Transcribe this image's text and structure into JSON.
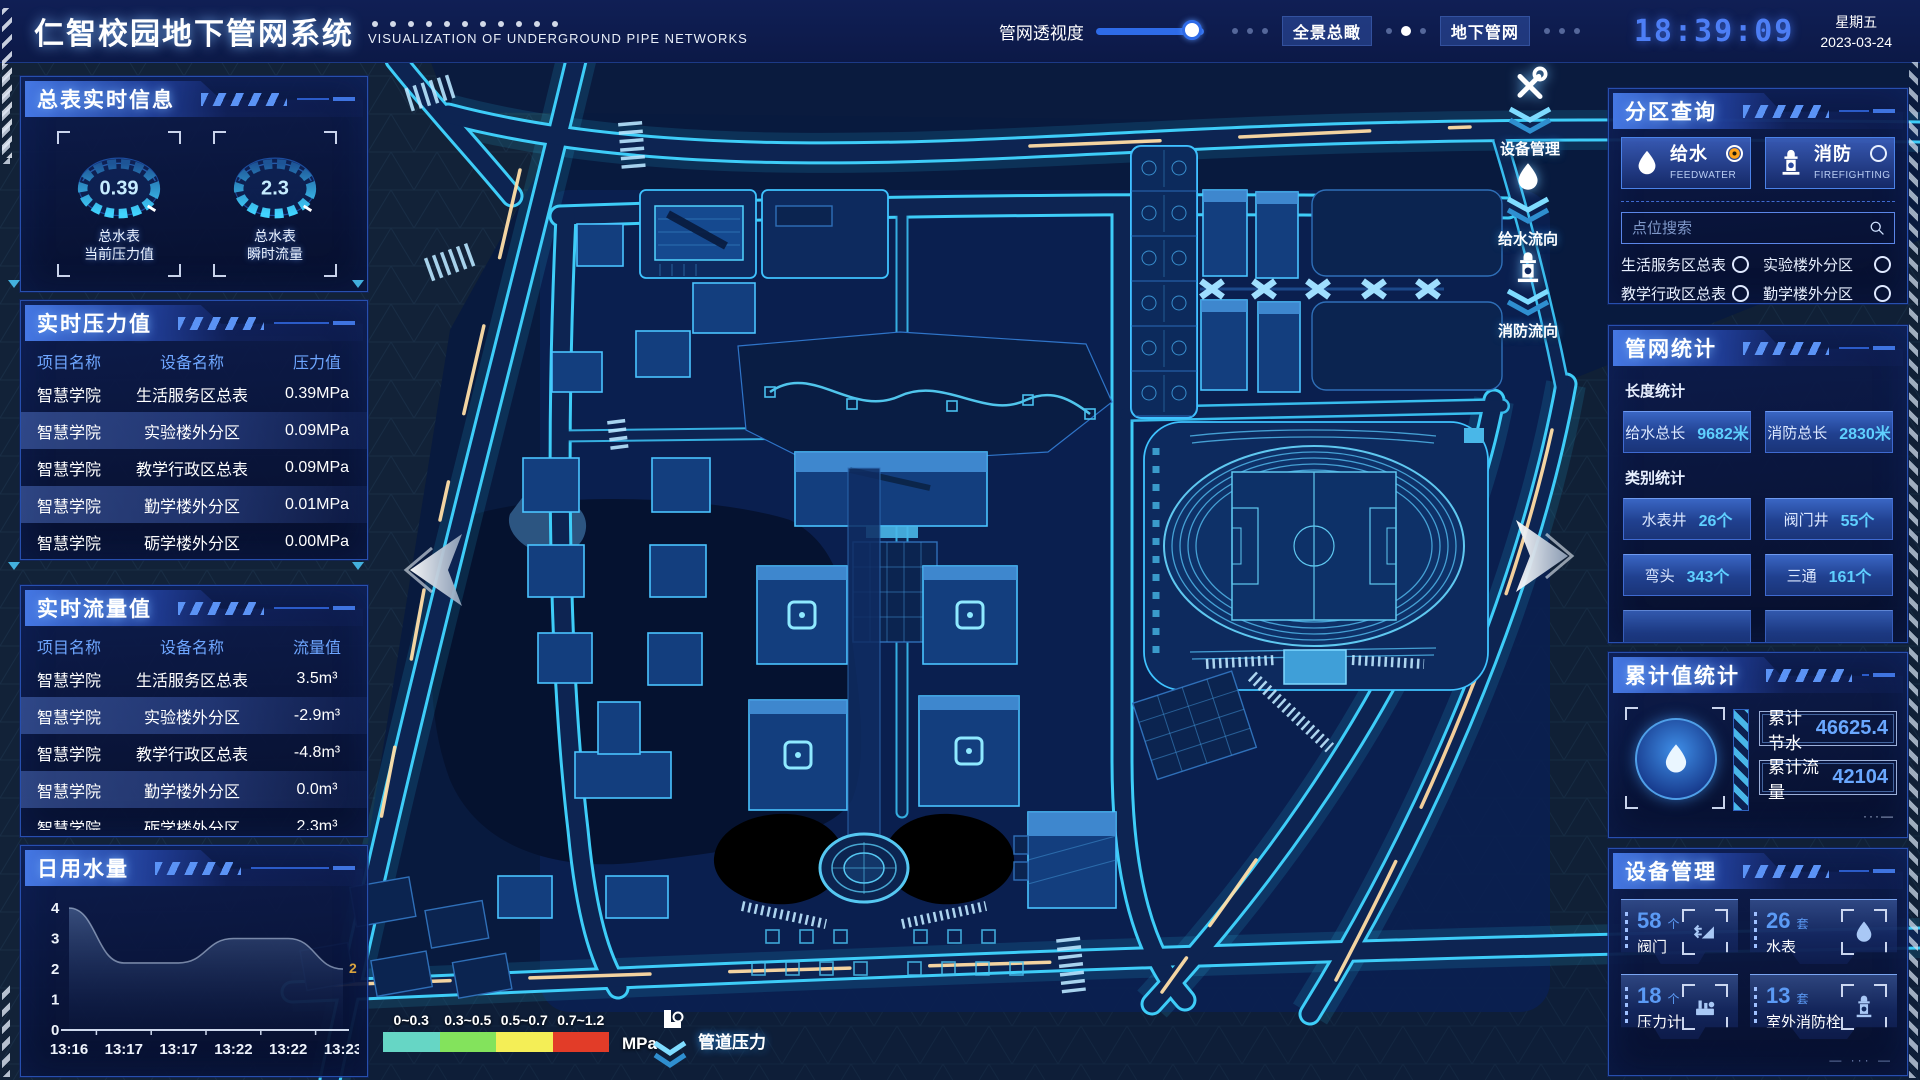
{
  "header": {
    "title": "仁智校园地下管网系统",
    "subtitle": "VISUALIZATION OF UNDERGROUND PIPE NETWORKS",
    "slider_label": "管网透视度",
    "view_buttons": [
      {
        "label": "全景总瞰"
      },
      {
        "label": "地下管网"
      }
    ],
    "clock": {
      "time": "18:39:09",
      "weekday": "星期五",
      "date": "2023-03-24"
    }
  },
  "left": {
    "meter_panel": {
      "title": "总表实时信息",
      "gauges": [
        {
          "value": "0.39",
          "name": "总水表",
          "metric": "当前压力值"
        },
        {
          "value": "2.3",
          "name": "总水表",
          "metric": "瞬时流量"
        }
      ]
    },
    "pressure_panel": {
      "title": "实时压力值",
      "headers": [
        "项目名称",
        "设备名称",
        "压力值"
      ],
      "rows": [
        [
          "智慧学院",
          "生活服务区总表",
          "0.39MPa"
        ],
        [
          "智慧学院",
          "实验楼外分区",
          "0.09MPa"
        ],
        [
          "智慧学院",
          "教学行政区总表",
          "0.09MPa"
        ],
        [
          "智慧学院",
          "勤学楼外分区",
          "0.01MPa"
        ],
        [
          "智慧学院",
          "砺学楼外分区",
          "0.00MPa"
        ]
      ]
    },
    "flow_panel": {
      "title": "实时流量值",
      "headers": [
        "项目名称",
        "设备名称",
        "流量值"
      ],
      "rows": [
        [
          "智慧学院",
          "生活服务区总表",
          "3.5m³"
        ],
        [
          "智慧学院",
          "实验楼外分区",
          "-2.9m³"
        ],
        [
          "智慧学院",
          "教学行政区总表",
          "-4.8m³"
        ],
        [
          "智慧学院",
          "勤学楼外分区",
          "0.0m³"
        ],
        [
          "智慧学院",
          "砺学楼外分区",
          "2.3m³"
        ]
      ]
    },
    "daily_panel": {
      "title": "日用水量"
    }
  },
  "chart_data": {
    "type": "area",
    "title": "日用水量",
    "x": [
      "13:16",
      "13:17",
      "13:17",
      "13:22",
      "13:22",
      "13:23"
    ],
    "values": [
      4,
      2.2,
      2.2,
      3,
      3,
      2
    ],
    "ylim": [
      0,
      4
    ],
    "yticks": [
      0,
      1,
      2,
      3,
      4
    ],
    "end_label": "2",
    "grid": false,
    "legend": "none"
  },
  "map": {
    "tools": [
      {
        "label": "设备管理"
      },
      {
        "label": "给水流向"
      },
      {
        "label": "消防流向"
      }
    ],
    "legend": {
      "ranges": [
        "0~0.3",
        "0.3~0.5",
        "0.5~0.7",
        "0.7~1.2"
      ],
      "colors": [
        "#66d6c5",
        "#83e35c",
        "#f4ee56",
        "#e23c28"
      ],
      "unit": "MPa",
      "label": "管道压力"
    }
  },
  "right": {
    "zone_panel": {
      "title": "分区查询",
      "tabs": [
        {
          "label": "给水",
          "sub": "FEEDWATER",
          "selected": true
        },
        {
          "label": "消防",
          "sub": "FIREFIGHTING",
          "selected": false
        }
      ],
      "search_placeholder": "点位搜索",
      "items": [
        "生活服务区总表",
        "实验楼外分区",
        "教学行政区总表",
        "勤学楼外分区",
        "砺学楼外分区",
        "宿舍区泵房"
      ]
    },
    "stats_panel": {
      "title": "管网统计",
      "length_label": "长度统计",
      "length_stats": [
        {
          "name": "给水总长",
          "value": "9682米"
        },
        {
          "name": "消防总长",
          "value": "2830米"
        }
      ],
      "category_label": "类别统计",
      "category_stats": [
        {
          "name": "水表井",
          "value": "26个"
        },
        {
          "name": "阀门井",
          "value": "55个"
        },
        {
          "name": "弯头",
          "value": "343个"
        },
        {
          "name": "三通",
          "value": "161个"
        }
      ]
    },
    "total_panel": {
      "title": "累计值统计",
      "stats": [
        {
          "name": "累计节水",
          "value": "46625.4"
        },
        {
          "name": "累计流量",
          "value": "42104"
        }
      ]
    },
    "device_panel": {
      "title": "设备管理",
      "devices": [
        {
          "count": "58",
          "unit": "个",
          "name": "阀门",
          "icon": "valve-icon"
        },
        {
          "count": "26",
          "unit": "套",
          "name": "水表",
          "icon": "water-meter-icon"
        },
        {
          "count": "18",
          "unit": "个",
          "name": "压力计",
          "icon": "pressure-gauge-icon"
        },
        {
          "count": "13",
          "unit": "套",
          "name": "室外消防栓",
          "icon": "hydrant-icon"
        }
      ]
    }
  }
}
